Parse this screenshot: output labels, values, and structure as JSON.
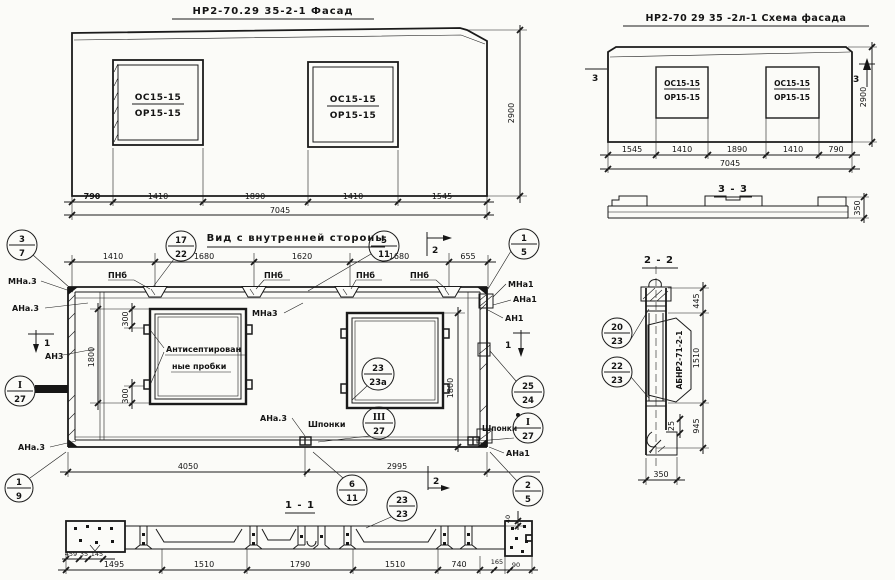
{
  "facade": {
    "title": "НР2-70.29 35-2-1 Фасад",
    "window1": {
      "top": "ОС15-15",
      "bottom": "ОР15-15"
    },
    "window2": {
      "top": "ОС15-15",
      "bottom": "ОР15-15"
    },
    "dims": [
      "790",
      "1410",
      "1890",
      "1410",
      "1545"
    ],
    "total": "7045",
    "height": "2900"
  },
  "schema": {
    "title": "НР2-70 29 35 -2л-1 Схема фасада",
    "window1": {
      "top": "ОС15-15",
      "bottom": "ОР15-15"
    },
    "window2": {
      "top": "ОС15-15",
      "bottom": "ОР15-15"
    },
    "dims": [
      "1545",
      "1410",
      "1890",
      "1410",
      "790"
    ],
    "total": "7045",
    "height": "2900",
    "marker_left": "3",
    "marker_right": "3"
  },
  "section33": {
    "title": "3 - 3",
    "height": "350"
  },
  "inner": {
    "title": "Вид с внутренней стороны",
    "top_dims": [
      "1410",
      "1680",
      "1620",
      "1680",
      "655"
    ],
    "pnb": "ПНб",
    "labels": {
      "mna3": "МНа.3",
      "ana3": "АНа.3",
      "an3": "АН3",
      "ana3_low": "АНа.3",
      "mna3_mid": "МНа3",
      "ana3_bot": "АНа.3",
      "mna1": "МНа1",
      "ana1": "АНа1",
      "an1": "АН1",
      "ana1_bot": "АНа1",
      "plugs1": "Антисептирован",
      "plugs2": "ные пробки",
      "shponki_mid": "Шпонки",
      "shponki_right": "Шпонки"
    },
    "dims": {
      "d300a": "300",
      "d300b": "300",
      "d1800l": "1800",
      "d1800r": "1800",
      "d4050": "4050",
      "d2995": "2995"
    },
    "marker1": "1",
    "marker2": "2"
  },
  "callouts": {
    "c37": {
      "t": "3",
      "b": "7"
    },
    "c1722": {
      "t": "17",
      "b": "22"
    },
    "c511": {
      "t": "5",
      "b": "11"
    },
    "c15": {
      "t": "1",
      "b": "5"
    },
    "c2524": {
      "t": "25",
      "b": "24"
    },
    "cI27L": {
      "t": "I",
      "b": "27"
    },
    "cIII27": {
      "t": "III",
      "b": "27"
    },
    "cI27R": {
      "t": "I",
      "b": "27"
    },
    "c25": {
      "t": "2",
      "b": "5"
    },
    "c611": {
      "t": "6",
      "b": "11"
    },
    "c19": {
      "t": "1",
      "b": "9"
    },
    "c2323a": {
      "t": "23",
      "b": "23а"
    },
    "c2323": {
      "t": "23",
      "b": "23"
    },
    "c2023": {
      "t": "20",
      "b": "23"
    },
    "c2223": {
      "t": "22",
      "b": "23"
    }
  },
  "section22": {
    "title": "2 - 2",
    "part_label": "АБНР2-71-2-1",
    "dims": {
      "d445": "445",
      "d1510": "1510",
      "d945": "945",
      "d25": "25",
      "d350": "350"
    }
  },
  "section11": {
    "title": "1 - 1",
    "dims": [
      "1495",
      "1510",
      "1790",
      "1510",
      "740"
    ],
    "small_dims": {
      "left1": "459",
      "left2": "35",
      "left3": "145",
      "right1": "165",
      "right2": "90",
      "top": "40"
    }
  },
  "colors": {
    "ink": "#1b1b1b",
    "paper": "#fbfbf8"
  }
}
